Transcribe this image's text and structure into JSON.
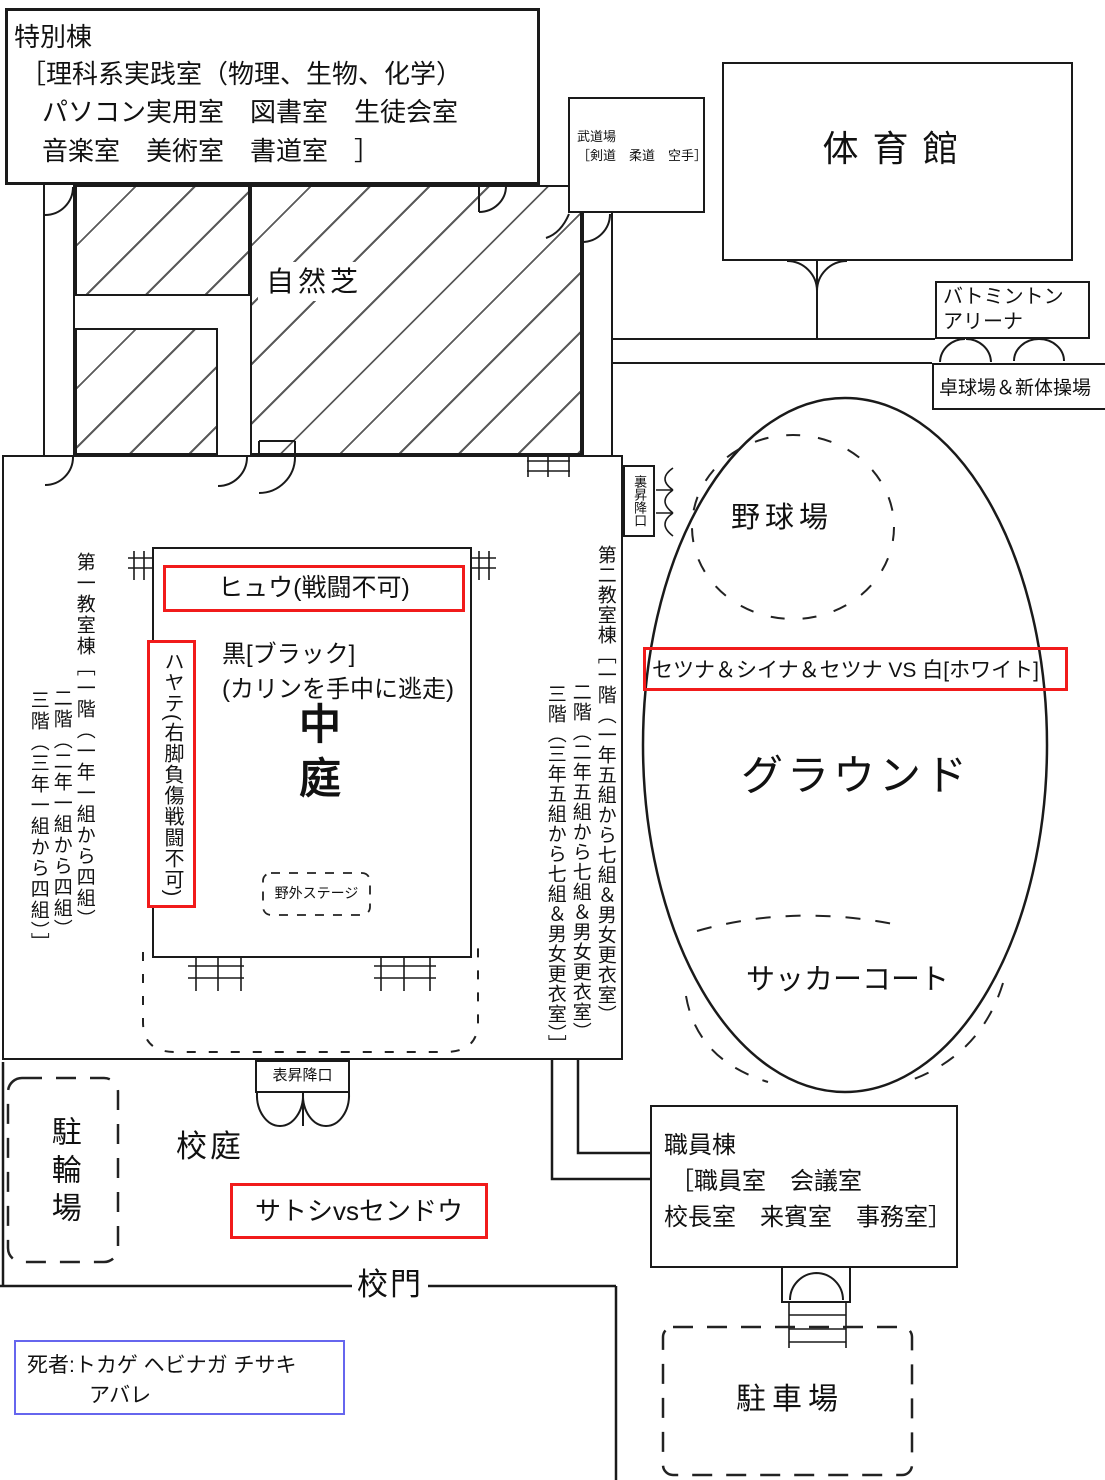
{
  "colors": {
    "red": "#f11b1b",
    "blue": "#6666ee",
    "ink": "#1a1a1a"
  },
  "special_building": {
    "name": "特別棟",
    "rooms_line1": "［理科系実践室（物理、生物、化学）",
    "rooms_line2": "パソコン実用室　図書室　生徒会室",
    "rooms_line3": "音楽室　美術室　書道室　］"
  },
  "budokan": {
    "name": "武道場",
    "rooms": "［剣道　柔道　空手］"
  },
  "gym": {
    "name": "体育館"
  },
  "badminton": {
    "line1": "バトミントン",
    "line2": "アリーナ"
  },
  "table_tennis": {
    "name": "卓球場＆新体操場"
  },
  "lawn": {
    "name": "自然芝"
  },
  "back_entrance": {
    "name": "裏昇降口"
  },
  "front_entrance": {
    "name": "表昇降口"
  },
  "classroom1": {
    "col1": "第一教室棟［一階（一年一組から四組）",
    "col2": "二階（二年一組から四組）",
    "col3": "三階（三年一組から四組）］"
  },
  "classroom2": {
    "col1": "第二教室棟［一階（一年五組から七組＆男女更衣室）",
    "col2": "二階（二年五組から七組＆男女更衣室）",
    "col3": "三階（三年五組から七組＆男女更衣室）］"
  },
  "courtyard": {
    "name": "中庭",
    "stage": "野外ステージ"
  },
  "battles": {
    "hyuu": "ヒュウ(戦闘不可)",
    "hayate": "ハヤテ(右脚負傷戦闘不可)",
    "black_line1": "黒[ブラック]",
    "black_line2": "(カリンを手中に逃走)",
    "setsuna_vs_white": "セツナ＆シイナ＆セツナ VS 白[ホワイト]",
    "satoshi_vs_sendou": "サトシvsセンドウ"
  },
  "ground": {
    "name": "グラウンド",
    "baseball": "野球場",
    "soccer": "サッカーコート"
  },
  "staff_building": {
    "name": "職員棟",
    "rooms_line1": "［職員室　会議室",
    "rooms_line2": "校長室　来賓室　事務室］"
  },
  "yard": {
    "schoolyard": "校庭",
    "gate": "校門",
    "bike_parking": "駐輪場",
    "car_parking": "駐車場"
  },
  "deaths": {
    "line1": "死者:トカゲ ヘビナガ チサキ",
    "line2": "アバレ"
  }
}
